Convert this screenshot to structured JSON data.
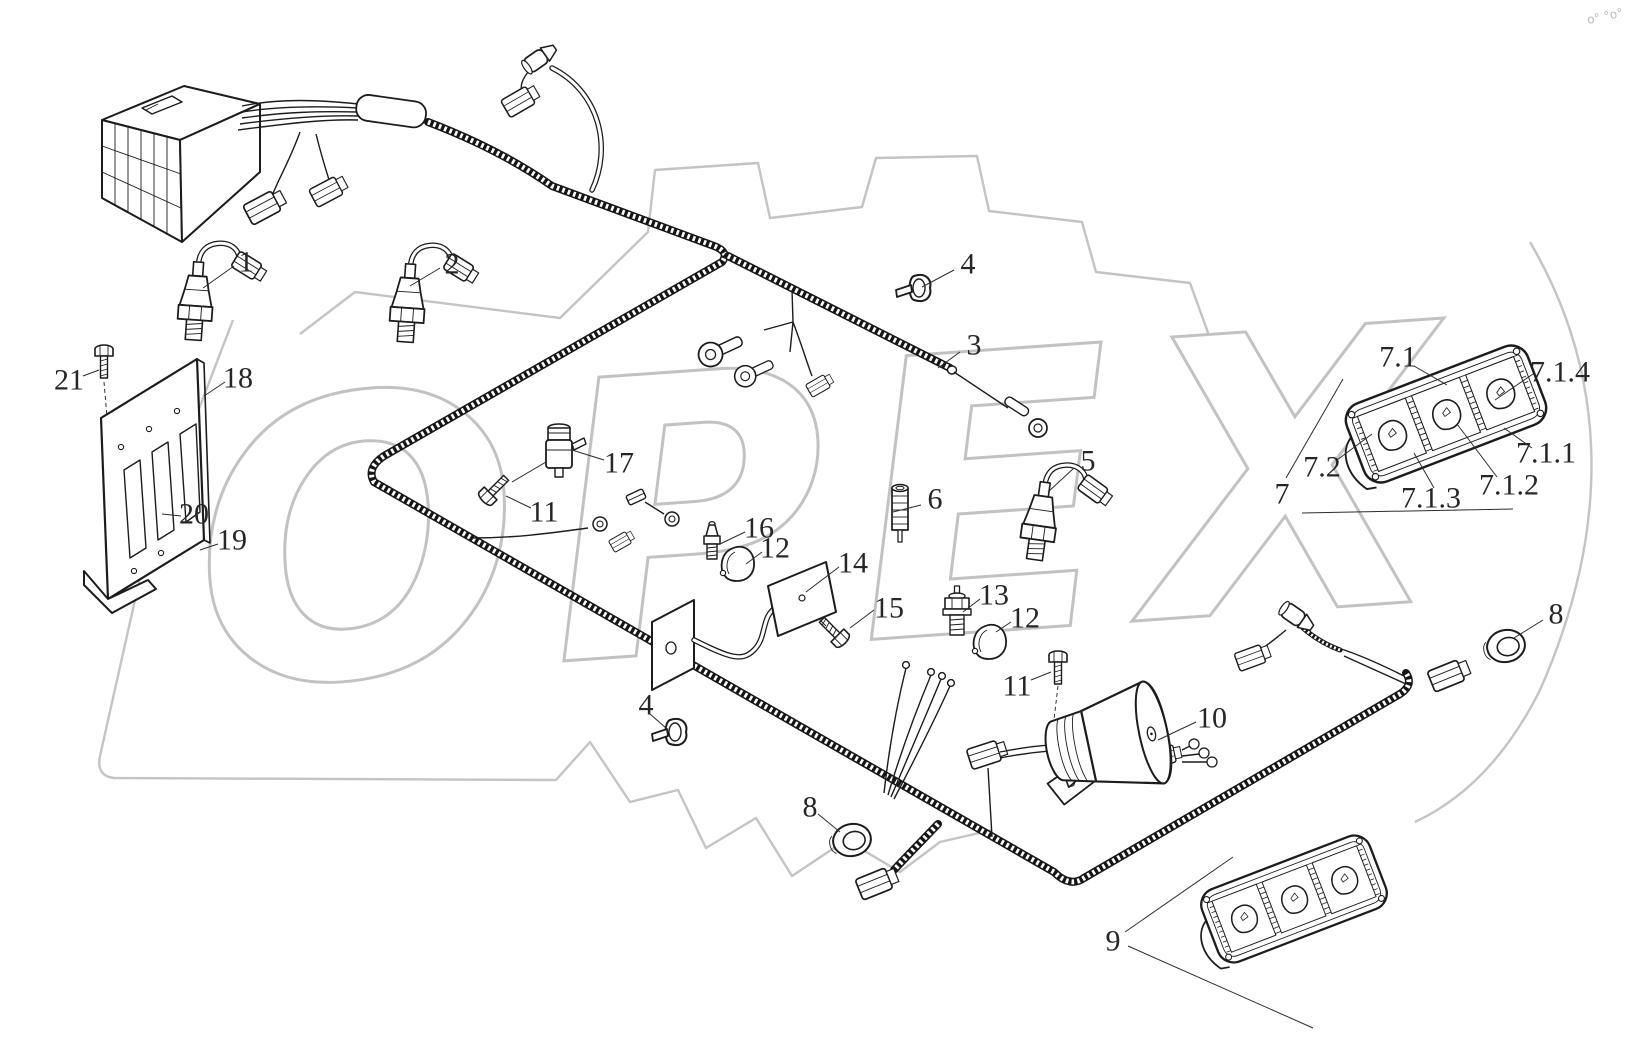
{
  "meta": {
    "background": "#ffffff",
    "ink_color": "#1c1c1c",
    "watermark_color": "#c4c4c4",
    "label_color": "#262626",
    "label_font_size": 30
  },
  "watermark": {
    "text": "OPEX",
    "corner_marks": "o° °o°"
  },
  "callouts": [
    {
      "text": "1",
      "x": 246,
      "y": 262,
      "leaders": [
        [
          234,
          266,
          203,
          288
        ]
      ]
    },
    {
      "text": "2",
      "x": 452,
      "y": 264,
      "leaders": [
        [
          440,
          268,
          410,
          286
        ]
      ]
    },
    {
      "text": "3",
      "x": 974,
      "y": 345,
      "leaders": [
        [
          960,
          352,
          938,
          368
        ]
      ]
    },
    {
      "text": "4",
      "x": 968,
      "y": 264,
      "leaders": [
        [
          954,
          270,
          922,
          287
        ]
      ]
    },
    {
      "text": "4",
      "x": 646,
      "y": 705,
      "leaders": [
        [
          650,
          714,
          666,
          728
        ]
      ]
    },
    {
      "text": "5",
      "x": 1088,
      "y": 461,
      "leaders": [
        [
          1074,
          468,
          1048,
          492
        ]
      ]
    },
    {
      "text": "6",
      "x": 935,
      "y": 499,
      "leaders": [
        [
          921,
          505,
          893,
          512
        ]
      ]
    },
    {
      "text": "7",
      "x": 1282,
      "y": 494,
      "leaders": [
        [
          1286,
          478,
          1343,
          379
        ]
      ]
    },
    {
      "text": "7.1",
      "x": 1398,
      "y": 357,
      "leaders": [
        [
          1414,
          366,
          1447,
          385
        ]
      ]
    },
    {
      "text": "7.1.4",
      "x": 1560,
      "y": 372,
      "leaders": [
        [
          1533,
          374,
          1495,
          400
        ]
      ]
    },
    {
      "text": "7.1.1",
      "x": 1546,
      "y": 453,
      "leaders": [
        [
          1532,
          448,
          1504,
          428
        ]
      ]
    },
    {
      "text": "7.1.2",
      "x": 1509,
      "y": 485,
      "leaders": [
        [
          1497,
          477,
          1457,
          424
        ]
      ]
    },
    {
      "text": "7.1.3",
      "x": 1431,
      "y": 498,
      "leaders": [
        [
          1434,
          488,
          1414,
          453
        ]
      ]
    },
    {
      "text": "7.2",
      "x": 1322,
      "y": 467,
      "leaders": [
        [
          1337,
          460,
          1372,
          434
        ]
      ]
    },
    {
      "text": "8",
      "x": 1556,
      "y": 614,
      "leaders": [
        [
          1543,
          620,
          1514,
          638
        ]
      ]
    },
    {
      "text": "8",
      "x": 810,
      "y": 807,
      "leaders": [
        [
          818,
          814,
          840,
          832
        ]
      ]
    },
    {
      "text": "9",
      "x": 1113,
      "y": 941,
      "leaders": [
        [
          1125,
          932,
          1233,
          857
        ],
        [
          1128,
          946,
          1313,
          1028
        ]
      ]
    },
    {
      "text": "10",
      "x": 1212,
      "y": 718,
      "leaders": [
        [
          1196,
          722,
          1158,
          740
        ]
      ]
    },
    {
      "text": "11",
      "x": 544,
      "y": 512,
      "leaders": [
        [
          531,
          508,
          506,
          496
        ]
      ]
    },
    {
      "text": "11",
      "x": 1017,
      "y": 686,
      "leaders": [
        [
          1031,
          680,
          1051,
          672
        ]
      ]
    },
    {
      "text": "12",
      "x": 775,
      "y": 548,
      "leaders": [
        [
          762,
          552,
          746,
          564
        ]
      ]
    },
    {
      "text": "12",
      "x": 1025,
      "y": 618,
      "leaders": [
        [
          1011,
          622,
          996,
          632
        ]
      ]
    },
    {
      "text": "13",
      "x": 994,
      "y": 595,
      "leaders": [
        [
          980,
          599,
          963,
          612
        ]
      ]
    },
    {
      "text": "14",
      "x": 853,
      "y": 563,
      "leaders": [
        [
          839,
          567,
          806,
          592
        ]
      ]
    },
    {
      "text": "15",
      "x": 889,
      "y": 608,
      "leaders": [
        [
          874,
          610,
          850,
          628
        ]
      ]
    },
    {
      "text": "16",
      "x": 759,
      "y": 528,
      "leaders": [
        [
          745,
          532,
          720,
          544
        ]
      ]
    },
    {
      "text": "17",
      "x": 619,
      "y": 463,
      "leaders": [
        [
          604,
          460,
          572,
          450
        ]
      ]
    },
    {
      "text": "18",
      "x": 238,
      "y": 378,
      "leaders": [
        [
          225,
          382,
          204,
          396
        ]
      ]
    },
    {
      "text": "19",
      "x": 232,
      "y": 540,
      "leaders": [
        [
          218,
          544,
          200,
          550
        ]
      ]
    },
    {
      "text": "20",
      "x": 194,
      "y": 514,
      "leaders": [
        [
          181,
          516,
          162,
          514
        ]
      ]
    },
    {
      "text": "21",
      "x": 69,
      "y": 380,
      "leaders": [
        [
          83,
          376,
          99,
          370
        ]
      ]
    }
  ],
  "extra_leader_lines": [
    [
      1302,
      513,
      1513,
      509
    ]
  ]
}
